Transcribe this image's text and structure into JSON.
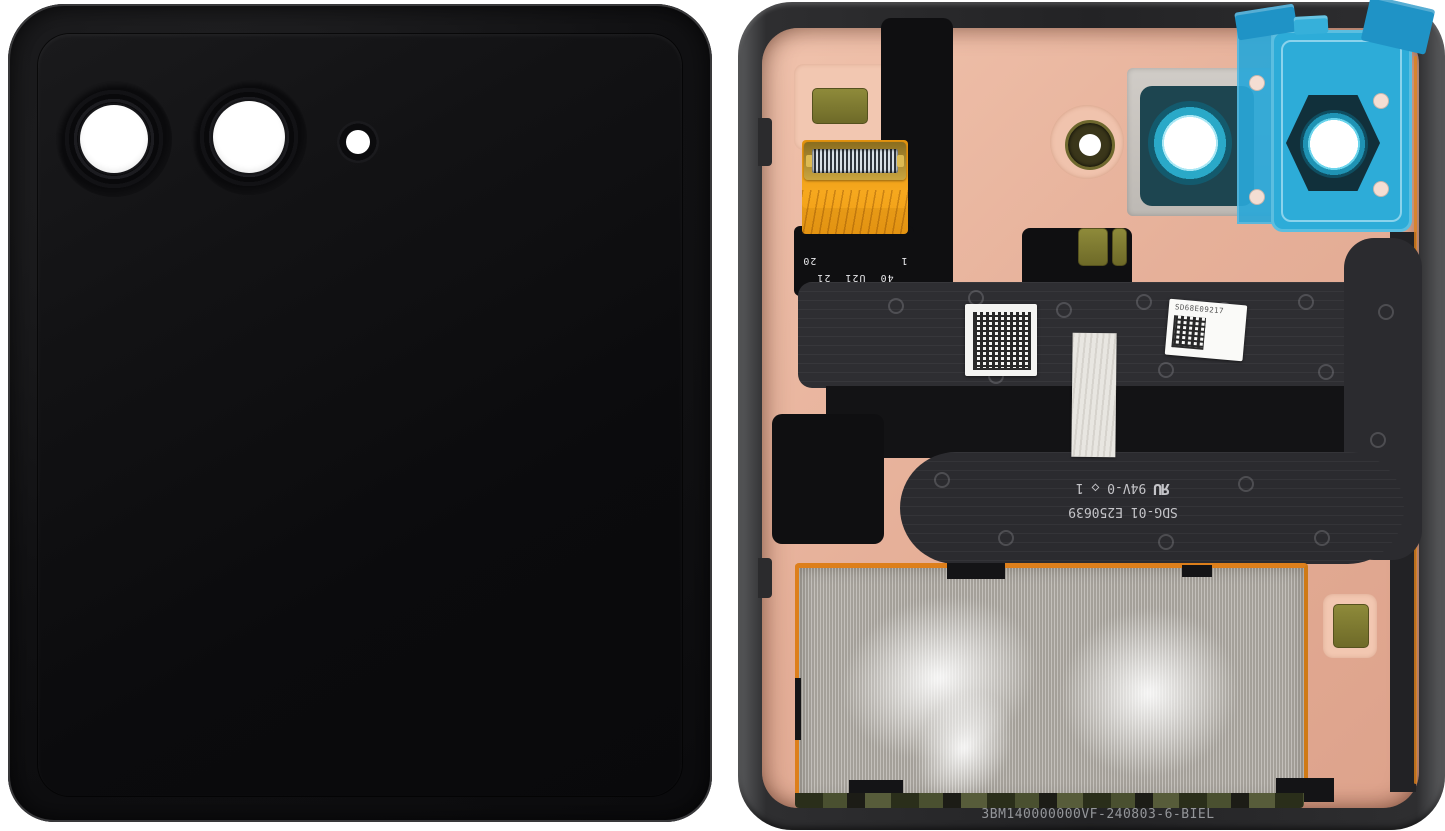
{
  "scene": {
    "background_color": "#ffffff",
    "left_part_name": "foldable-phone-cover-front-glass",
    "right_part_name": "foldable-phone-cover-display-rear-assembly"
  },
  "markings": {
    "pin_row_far": "40  U21  21",
    "pin_row_near": "1            20",
    "serial_label": "SD68E09217",
    "flex_part": "SDG-01 E250639",
    "ul_mark": "ЯU",
    "ul_rating": " 94V-0 ◇ 1",
    "bottom_part_number": "3BM140000000VF-240803-6-BIEL"
  },
  "colors": {
    "copper_plate": "#e6b099",
    "frame_gray": "#2e2e30",
    "glass_black": "#0d0d0f",
    "flex_graphite": "#2e2e32",
    "flex_orange": "#f2a31d",
    "protective_film_blue": "#2dacd8",
    "lens_ring_teal": "#2aa9c8",
    "foil_silver": "#b3afa8",
    "pad_olive": "#857f32",
    "pcb_green": "#3f4428"
  }
}
